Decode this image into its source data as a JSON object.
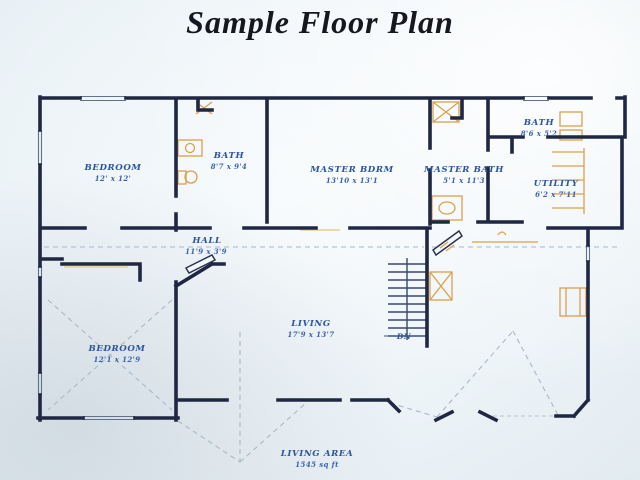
{
  "title": "Sample Floor Plan",
  "plan": {
    "rooms": [
      {
        "name": "BEDROOM",
        "dims": "12' x 12'"
      },
      {
        "name": "BATH",
        "dims": "8'7 x 9'4"
      },
      {
        "name": "MASTER BDRM",
        "dims": "13'10 x 13'1"
      },
      {
        "name": "MASTER BATH",
        "dims": "5'1 x 11'3"
      },
      {
        "name": "BATH",
        "dims": "8'6 x 5'2"
      },
      {
        "name": "UTILITY",
        "dims": "6'2 x 7'11"
      },
      {
        "name": "HALL",
        "dims": "11'9 x 3'9"
      },
      {
        "name": "LIVING",
        "dims": "17'9 x 13'7"
      },
      {
        "name": "BEDROOM",
        "dims": "12'1 x 12'9"
      }
    ],
    "stairs_label": "DN",
    "footer": {
      "label": "LIVING AREA",
      "value": "1545 sq ft"
    }
  },
  "colors": {
    "wall": "#1f2742",
    "label_blue": "#2d55a0",
    "fixture_orange": "#d9a04e",
    "pencil_gray": "#a9b8c8",
    "paper": "#ecf3f7",
    "title_ink": "#17171f"
  }
}
